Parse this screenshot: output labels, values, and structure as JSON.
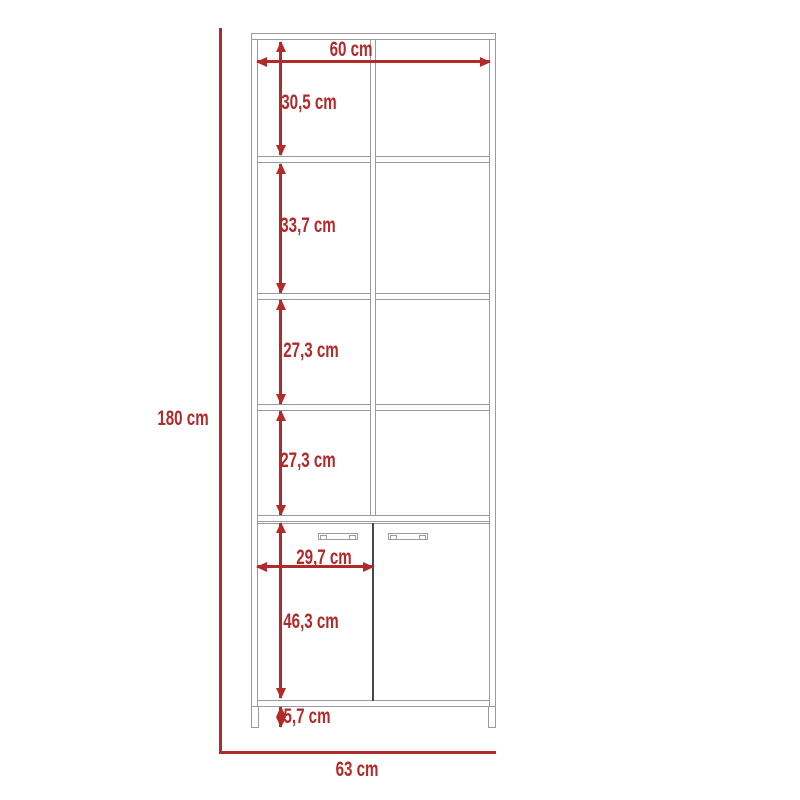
{
  "diagram": {
    "title": "bookcase-cabinet-dimension-diagram",
    "unit": "cm",
    "colors": {
      "dimension": "#b22a2a",
      "outline": "#9b9b9b",
      "door_divider": "#474747",
      "background": "#ffffff"
    },
    "dimensions": {
      "total_height": {
        "label": "180 cm",
        "value": 180
      },
      "top_width": {
        "label": "60 cm",
        "value": 60
      },
      "section_1_height": {
        "label": "30,5 cm",
        "value": 30.5
      },
      "section_2_height": {
        "label": "33,7 cm",
        "value": 33.7
      },
      "section_3_height": {
        "label": "27,3 cm",
        "value": 27.3
      },
      "section_4_height": {
        "label": "27,3 cm",
        "value": 27.3
      },
      "door_width": {
        "label": "29,7 cm",
        "value": 29.7
      },
      "door_height": {
        "label": "46,3 cm",
        "value": 46.3
      },
      "base_height": {
        "label": "5,7 cm",
        "value": 5.7
      },
      "base_width": {
        "label": "63 cm",
        "value": 63
      }
    },
    "structure": {
      "open_cubby_rows": 4,
      "cubby_columns": 2,
      "doors": 2,
      "door_handles": 2,
      "legs": 2
    }
  }
}
